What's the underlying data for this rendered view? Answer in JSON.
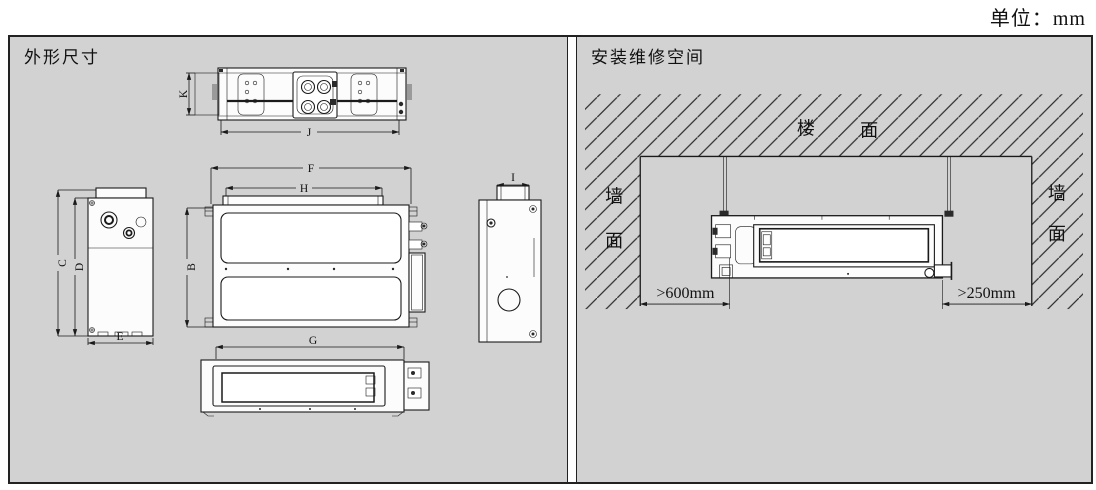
{
  "units_label": "单位：mm",
  "left_panel": {
    "title": "外形尺寸",
    "dim_labels": {
      "top_view_depth": "K",
      "top_view_width": "J",
      "overall_width": "F",
      "outlet_width": "H",
      "body_depth": "B",
      "front_width": "G",
      "overall_height": "C",
      "body_height": "D",
      "bottom_depth": "E",
      "flange_width": "I"
    }
  },
  "right_panel": {
    "title": "安装维修空间",
    "ceiling_label": {
      "char1": "楼",
      "char2": "面"
    },
    "left_wall_label": {
      "char1": "墙",
      "char2": "面"
    },
    "right_wall_label": {
      "char1": "墙",
      "char2": "面"
    },
    "left_clearance": ">600mm",
    "right_clearance": ">250mm",
    "colors": {
      "panel_background": "#d2d2d2",
      "line": "#1a1a1a"
    }
  }
}
